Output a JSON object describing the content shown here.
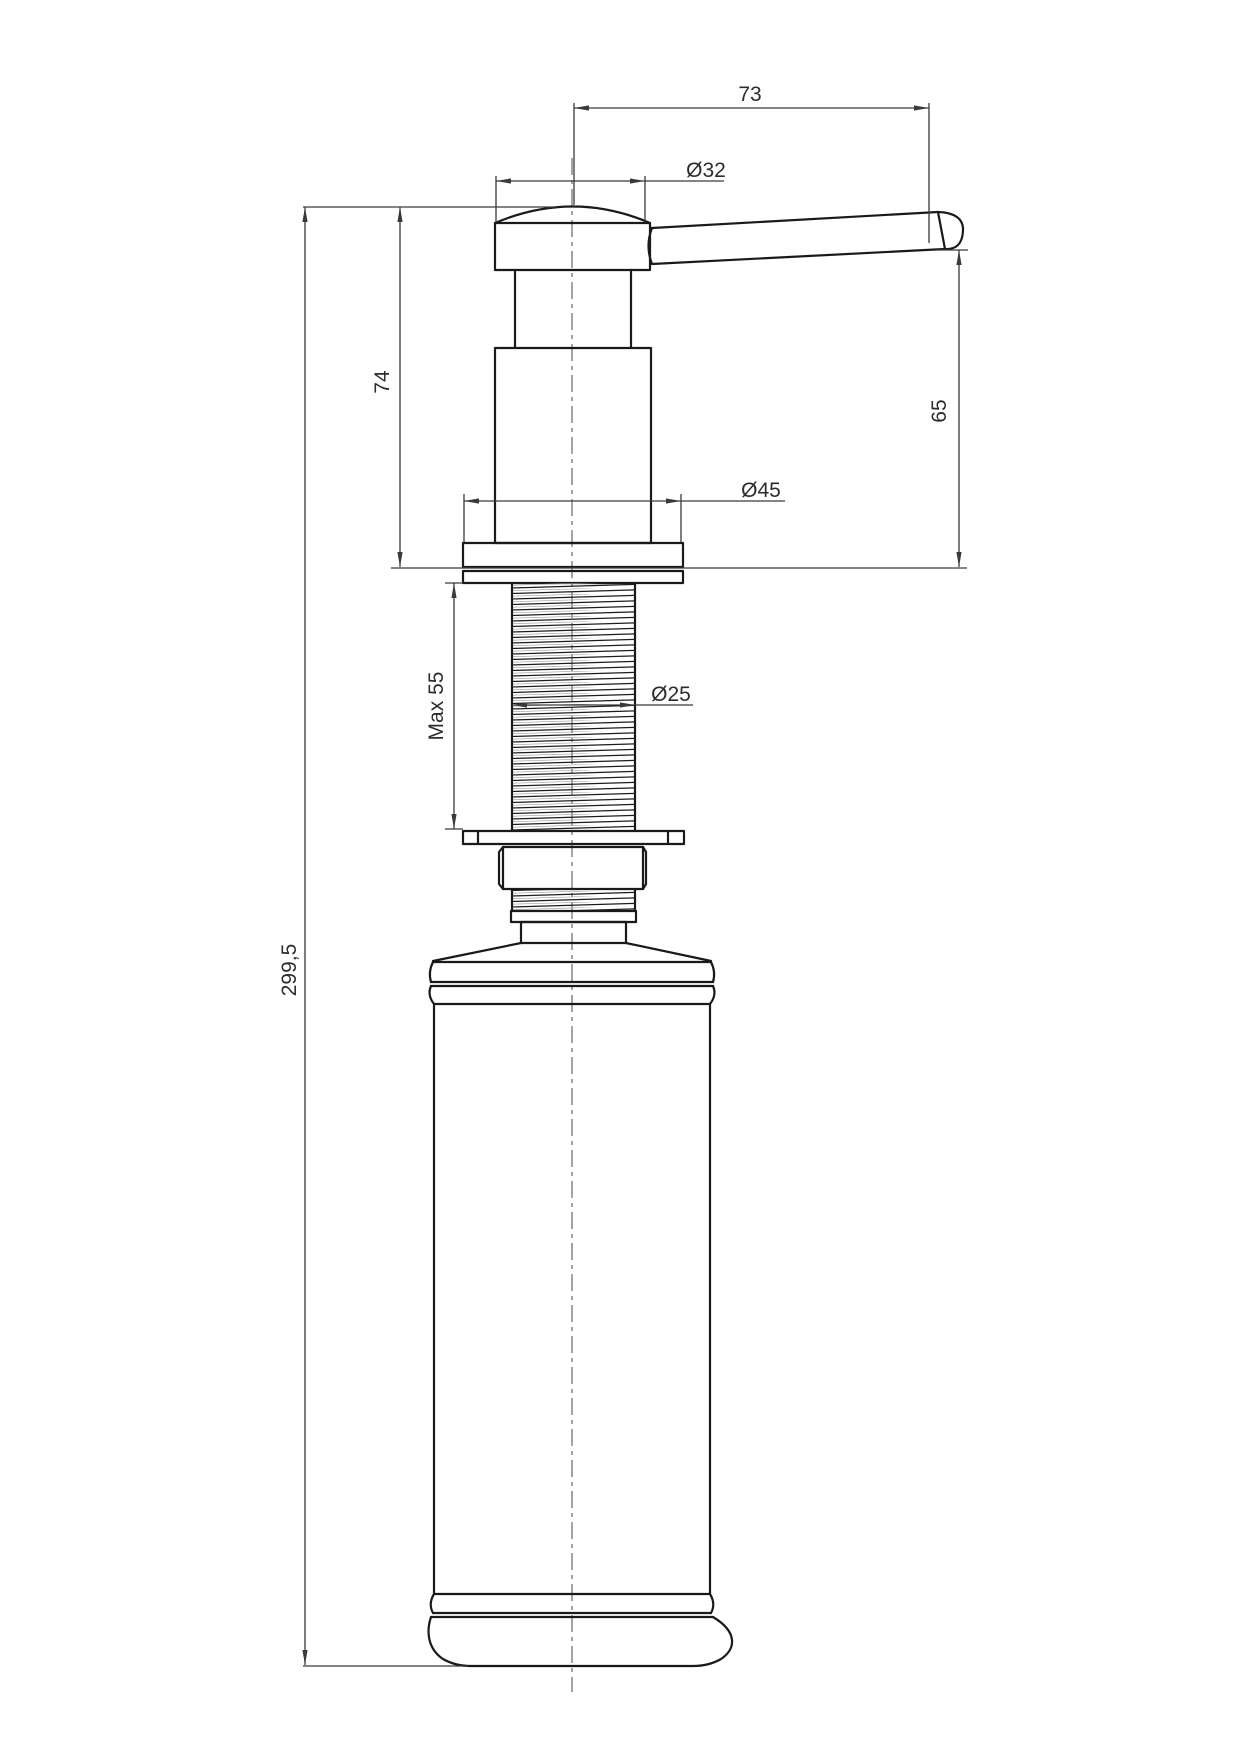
{
  "drawing": {
    "dimensions": {
      "reach": "73",
      "head_dia": "Ø32",
      "spout_height": "65",
      "pump_height": "74",
      "flange_dia": "Ø45",
      "max_thickness": "Max 55",
      "thread_dia": "Ø25",
      "overall_height": "299,5"
    },
    "line_color": "#1a1a1a",
    "dim_color": "#3a3a3a"
  }
}
